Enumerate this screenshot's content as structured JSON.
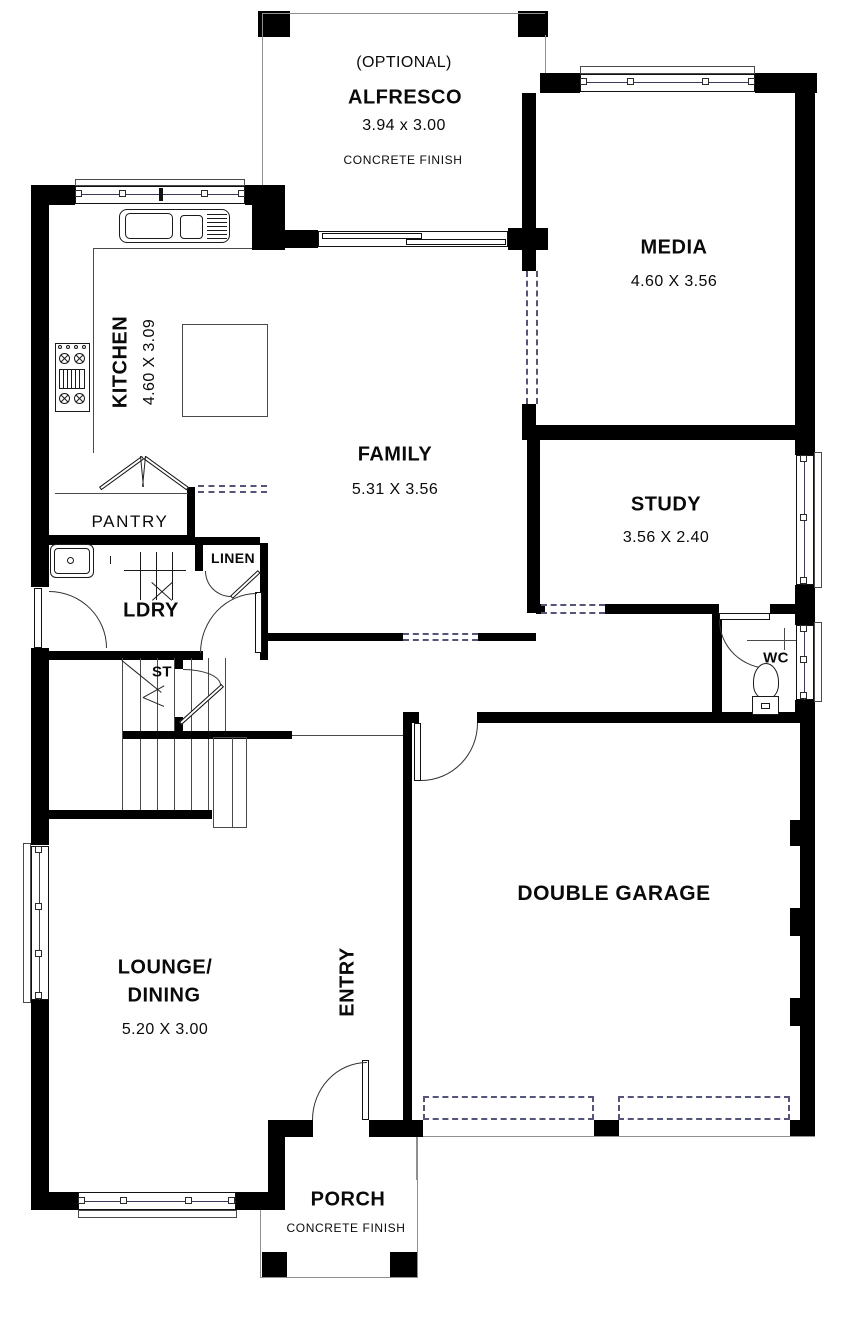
{
  "colors": {
    "wall": "#000000",
    "dash": "#55557a",
    "window_line": "#3a3a5e",
    "outline_dark": "#4a4a4a",
    "outline_gray": "#8f8f8f",
    "text": "#0a0a0a",
    "background": "#ffffff"
  },
  "rooms": {
    "alfresco": {
      "tag": "(OPTIONAL)",
      "name": "ALFRESCO",
      "dims": "3.94 x 3.00",
      "finish": "CONCRETE FINISH"
    },
    "media": {
      "name": "MEDIA",
      "dims": "4.60 X 3.56"
    },
    "kitchen": {
      "name": "KITCHEN",
      "dims": "4.60 X 3.09"
    },
    "family": {
      "name": "FAMILY",
      "dims": "5.31 X 3.56"
    },
    "study": {
      "name": "STUDY",
      "dims": "3.56 X 2.40"
    },
    "pantry": {
      "name": "PANTRY"
    },
    "linen": {
      "name": "LINEN"
    },
    "laundry": {
      "name": "LDRY"
    },
    "stairs": {
      "name": "ST"
    },
    "wc": {
      "name": "WC"
    },
    "garage": {
      "name": "DOUBLE GARAGE"
    },
    "lounge_dining": {
      "name_line1": "LOUNGE/",
      "name_line2": "DINING",
      "dims": "5.20 X 3.00"
    },
    "entry": {
      "name": "ENTRY"
    },
    "porch": {
      "name": "PORCH",
      "finish": "CONCRETE FINISH"
    }
  },
  "fixtures": [
    "kitchen-sink-icon",
    "cooktop-icon",
    "island-bench",
    "laundry-tub-icon",
    "toilet-icon",
    "staircase",
    "sliding-door",
    "windows",
    "hinged-doors"
  ]
}
